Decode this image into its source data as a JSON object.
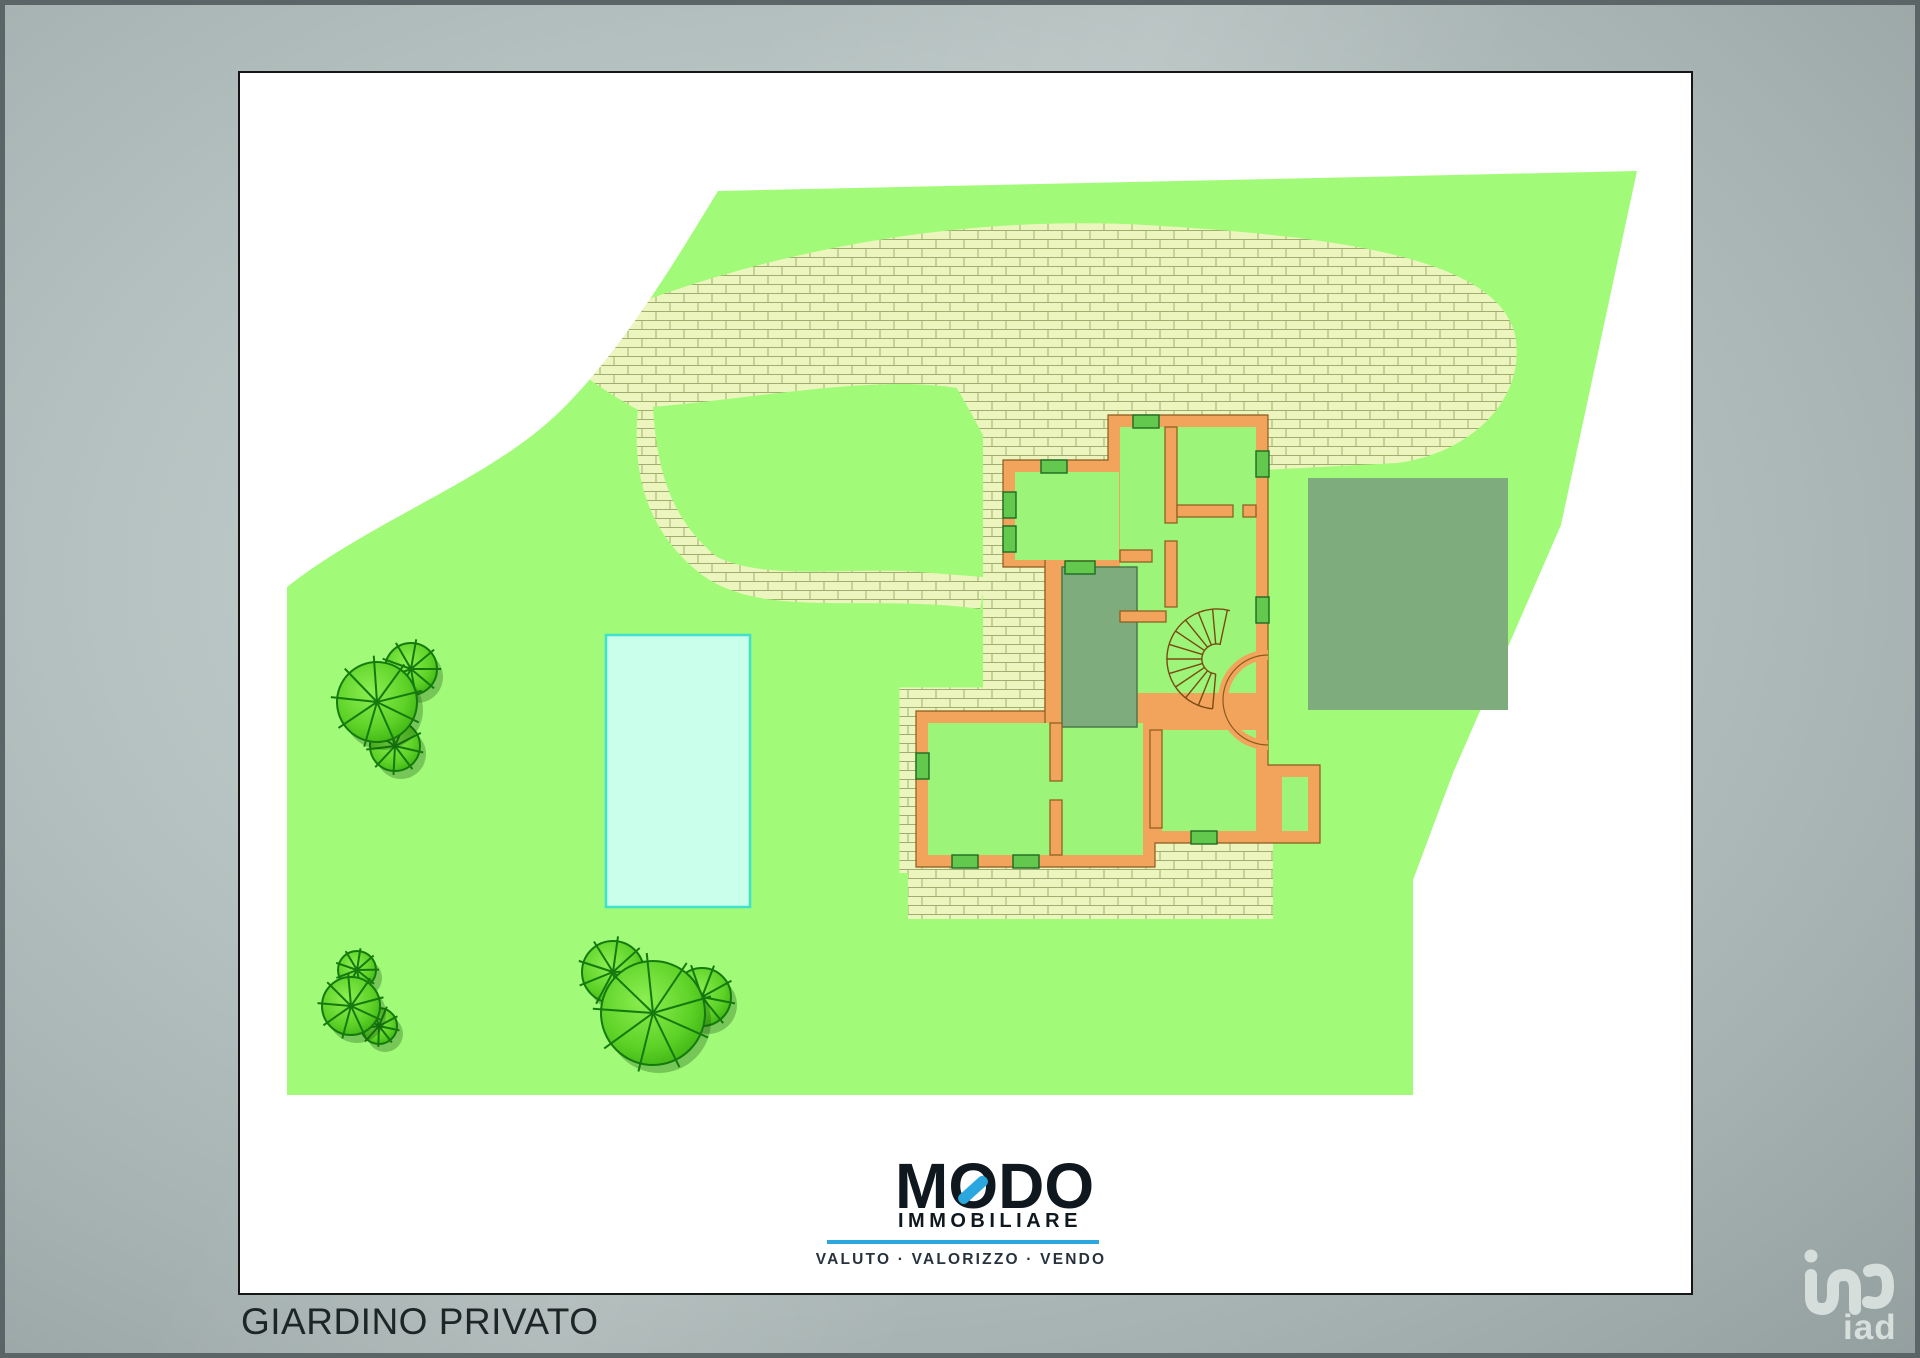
{
  "window": {
    "label": "GIARDINO PRIVATO"
  },
  "brand": {
    "letters": [
      "M",
      "O",
      "D",
      "O"
    ],
    "subtitle": "IMMOBILIARE",
    "tagline": "VALUTO · VALORIZZO · VENDO",
    "accent_color": "#2aa7de",
    "text_color": "#10181f"
  },
  "watermark": {
    "label": "iad"
  },
  "plan": {
    "type": "garden-site-plan",
    "colors": {
      "garden_green": "#a1fb79",
      "paving_fill": "#edf5be",
      "paving_grout": "#9fae6e",
      "building_wall": "#f2a45c",
      "room_interior": "#9cf478",
      "terrace_green": "#7eac7d",
      "pool_fill": "#c9ffeb",
      "pool_border": "#3fe0cc",
      "tree_green": "#44be14"
    }
  }
}
